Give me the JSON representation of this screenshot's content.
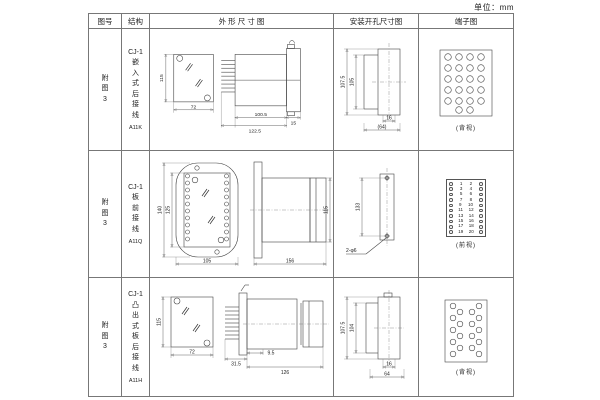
{
  "unit_label": "单位：mm",
  "header": {
    "figure": "图号",
    "structure": "结构",
    "outline": "外 形 尺 寸 图",
    "mounting": "安装开孔尺寸图",
    "terminal": "端子图"
  },
  "rows": [
    {
      "figure": "附\n图\n3",
      "structure": "CJ-1\n嵌\n入\n式\n后\n接\n线",
      "model": "A11K",
      "outline": {
        "height": "115",
        "width": "72",
        "depth_body": "100.5",
        "depth_total": "122.5",
        "flange": "15"
      },
      "mounting": {
        "outer": "107.5",
        "inner": "105",
        "slot": "16",
        "span": "(64)"
      },
      "terminal": {
        "view": "(背视)"
      }
    },
    {
      "figure": "附\n图\n3",
      "structure": "CJ-1\n板\n前\n接\n线",
      "model": "A11Q",
      "outline": {
        "outer_height": "140",
        "inner_height": "125",
        "width": "105",
        "length": "156",
        "height": "115"
      },
      "mounting": {
        "span": "133",
        "holes": "2-φ6"
      },
      "terminal": {
        "view": "(前视)",
        "left_numbers": [
          1,
          3,
          5,
          7,
          9,
          11,
          13,
          15,
          17,
          19
        ],
        "right_numbers": [
          2,
          4,
          6,
          8,
          10,
          12,
          14,
          16,
          18,
          20
        ]
      }
    },
    {
      "figure": "附\n图\n3",
      "structure": "CJ-1\n凸\n出\n式\n板\n后\n接\n线",
      "model": "A11H",
      "outline": {
        "height": "115",
        "width": "72",
        "pins": "31.5",
        "flange": "9.5",
        "length": "126"
      },
      "mounting": {
        "outer": "107.5",
        "inner": "104",
        "slot": "16",
        "span": "64"
      },
      "terminal": {
        "view": "(背视)"
      }
    }
  ]
}
